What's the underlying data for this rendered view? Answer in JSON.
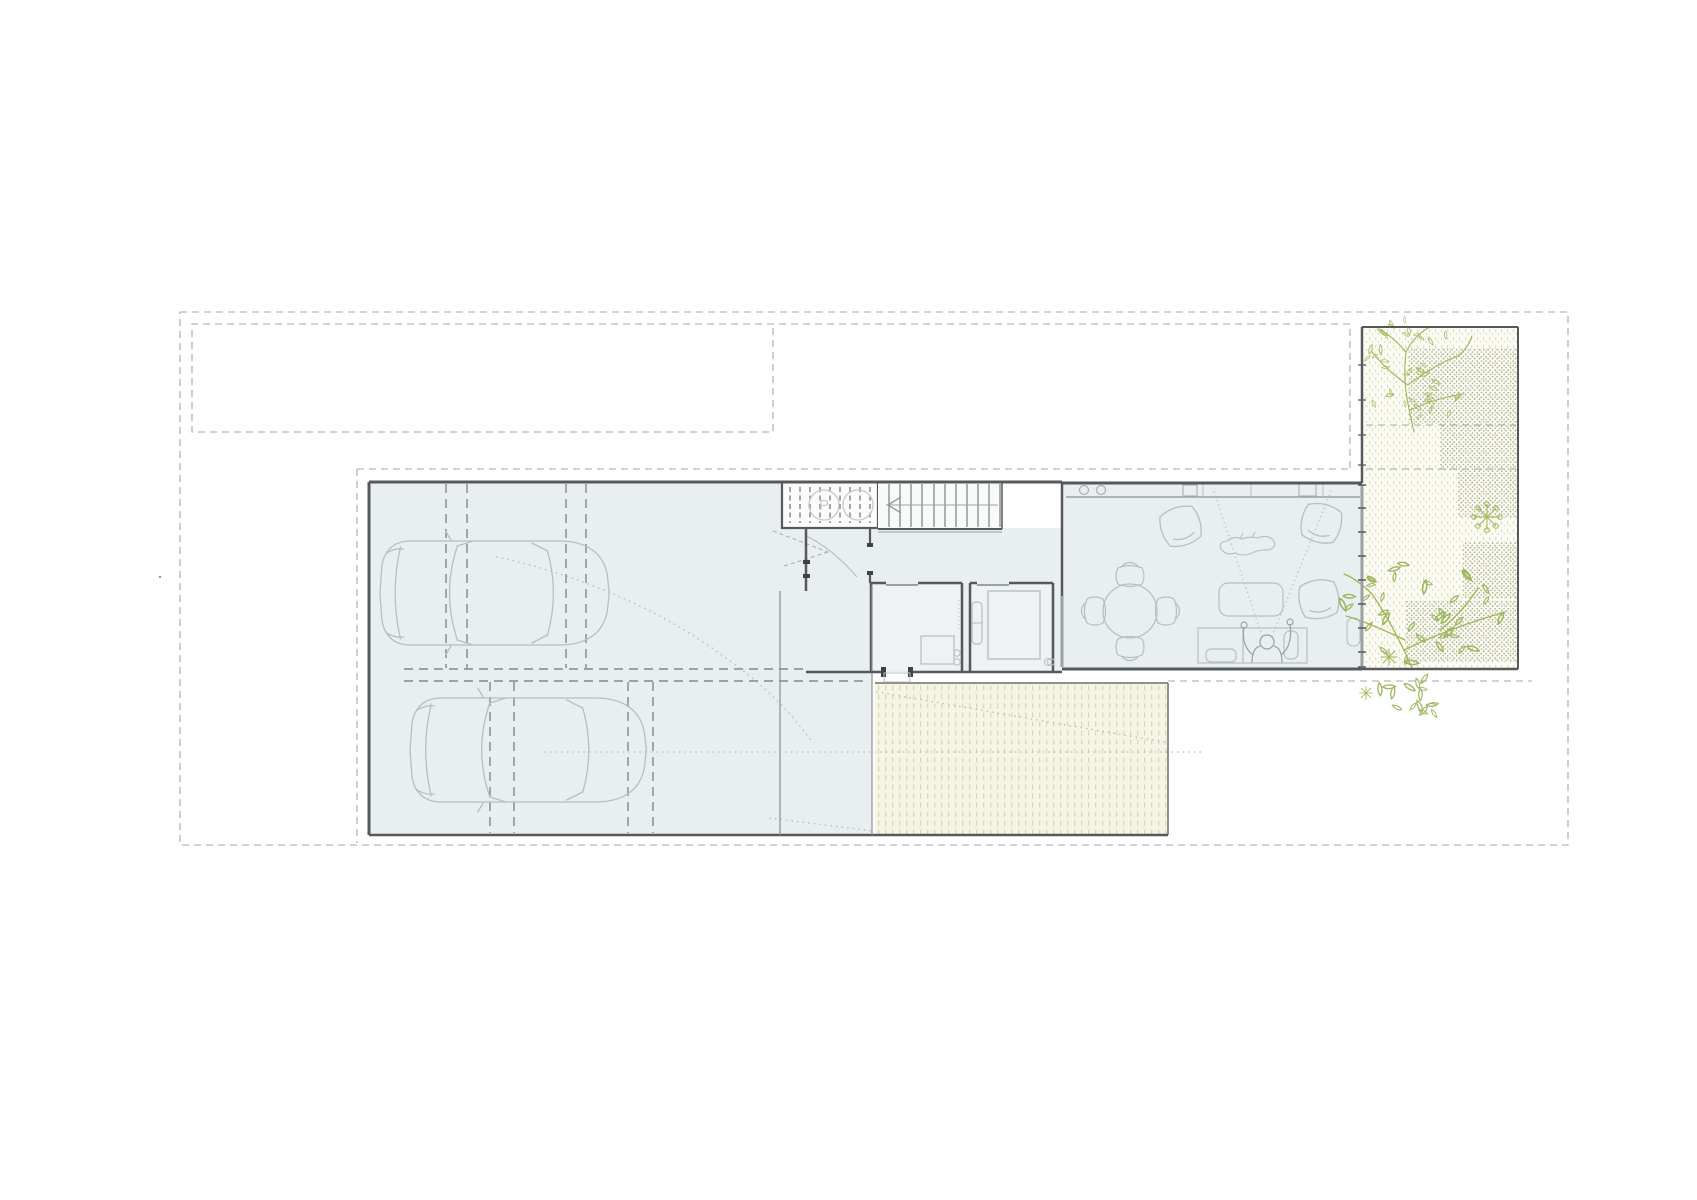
{
  "document": {
    "type": "architectural-floor-plan",
    "view": "ground floor site plan, top view, no title block, no dimension text"
  },
  "labels": {
    "porch_circle": "P"
  },
  "palette": {
    "background": "#ffffff",
    "interior_fill": "#e9eef0",
    "wall_dark": "#55595b",
    "furniture_line": "#b6bfc3",
    "boundary_dash": "#a3a8ab",
    "parking_dash": "#83878a",
    "glass_line": "#9aa1a4",
    "yard_fill": "#f6f5e5",
    "yard_hatch": "#dcd9ae",
    "garden_fill": "#fcfcf4",
    "garden_dot": "#c9c9ae",
    "garden_dot_dense": "#abaf92",
    "plant_green": "#9db757"
  },
  "rooms": [
    {
      "id": "garage",
      "desc": "garage / driveway with two cars and dashed parking bays"
    },
    {
      "id": "porch-deck",
      "desc": "slatted deck with two round planters, left one marked P"
    },
    {
      "id": "staircase",
      "desc": "straight stair flight with direction arrow"
    },
    {
      "id": "entry-hall",
      "desc": "entry hall with door swing and draught lines"
    },
    {
      "id": "bathroom-a",
      "desc": "bathroom with shower tray and WC fittings"
    },
    {
      "id": "bathroom-b",
      "desc": "shower room with enclosure and towel radiator"
    },
    {
      "id": "living-dining",
      "desc": "open living-dining room with kitchen counter along top wall"
    },
    {
      "id": "rear-yard",
      "desc": "hatched rear terrace"
    },
    {
      "id": "garden",
      "desc": "gravel side garden with trees and shrubs"
    }
  ],
  "inventory": {
    "cars": 2,
    "parking_bays": 2,
    "dining_table": "round, 4 chairs",
    "armchairs": 3,
    "sofa": "1, with seated figure",
    "lying_figure": 1,
    "coffee_table": 1,
    "side_table": 1,
    "kitchen_items": [
      "two hob burners",
      "sink square",
      "second sink square",
      "counter seams"
    ],
    "bath_items": [
      "shower tray",
      "shower enclosure",
      "towel radiator"
    ],
    "garden_items": [
      "large tree top",
      "large tree bottom",
      "umbel shrub",
      "star sprigs",
      "dense gravel patches"
    ],
    "boundary": "dashed property and setback lines around the plot"
  }
}
